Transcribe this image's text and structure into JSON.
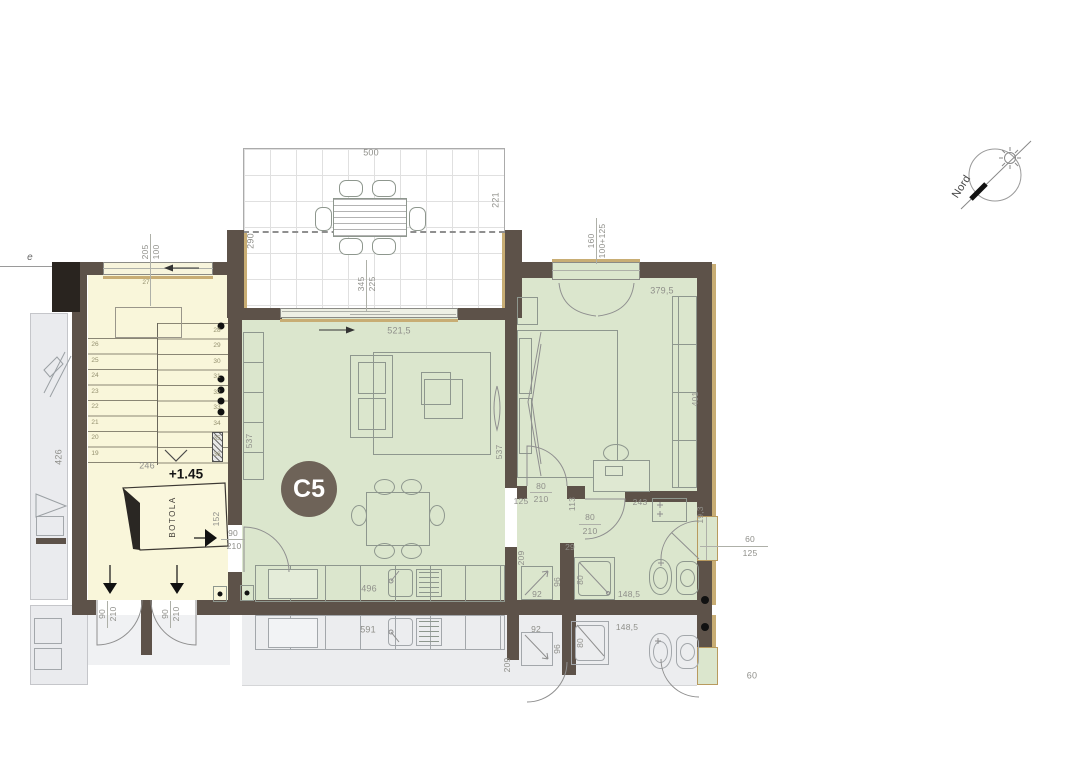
{
  "unit": {
    "label": "C5"
  },
  "north": {
    "label": "Nord"
  },
  "misc": {
    "stray_e": "e"
  },
  "terrace": {
    "width": "500",
    "right": "221",
    "left": "290",
    "inner_top": "345",
    "inner_bottom": "225"
  },
  "stairwell": {
    "window_w": "205",
    "window_h": "100",
    "width": "246",
    "level": "+1.45",
    "trapdoor": "BOTOLA",
    "top_step": "27",
    "left_steps": [
      "26",
      "25",
      "24",
      "23",
      "22",
      "21",
      "20",
      "19"
    ],
    "right_steps": [
      "28",
      "29",
      "30",
      "31",
      "32",
      "33",
      "34",
      "35",
      "36"
    ],
    "entry_door_w": "90",
    "entry_door_h": "210",
    "entry_side": "152",
    "exit1_w": "90",
    "exit1_h": "210",
    "exit2_w": "90",
    "exit2_h": "210"
  },
  "neighbor_left": {
    "depth": "426"
  },
  "living": {
    "window": "521,5",
    "side_left": "537",
    "side_right": "537",
    "kitchen": "496"
  },
  "bedroom": {
    "window_w": "160",
    "window_h": "100+125",
    "width": "379,5",
    "depth": "401",
    "door_w": "80",
    "door_h": "210",
    "door_offset": "125",
    "jamb": "113"
  },
  "bath": {
    "door_w": "80",
    "door_h": "210",
    "width": "243",
    "hall_len": "209",
    "stub": "29",
    "shower_w": "92",
    "shower_d": "96",
    "shower_door": "80",
    "length": "148,5",
    "pier": "19,3",
    "window_w": "60",
    "window_h": "125"
  },
  "neighbor_below": {
    "kitchen": "591",
    "shower_w": "92",
    "shower_d": "96",
    "shower_door": "80",
    "length": "148,5",
    "hall_len": "209",
    "window_w": "60"
  }
}
